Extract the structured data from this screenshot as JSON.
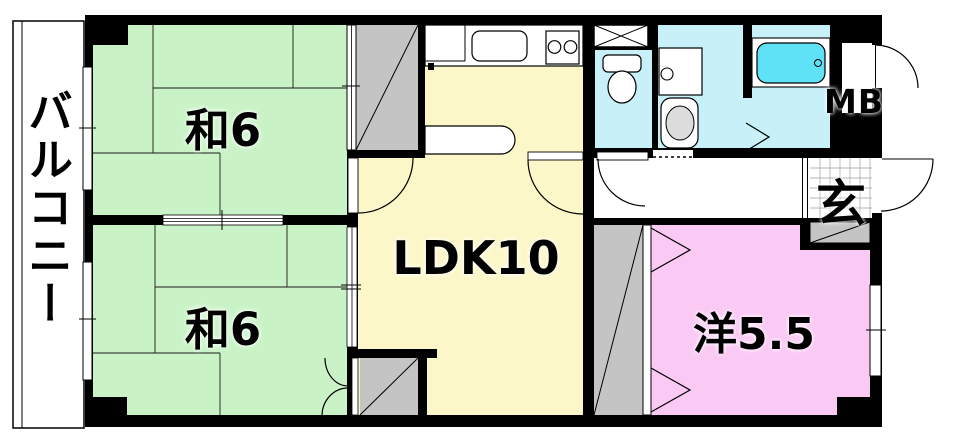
{
  "balcony": {
    "label": "バルコニー"
  },
  "rooms": {
    "japanese_top": {
      "label": "和6"
    },
    "japanese_bottom": {
      "label": "和6"
    },
    "ldk": {
      "label": "LDK10"
    },
    "western": {
      "label": "洋5.5"
    },
    "entrance": {
      "label": "玄"
    },
    "meter_box": {
      "label": "MB"
    }
  },
  "colors": {
    "wall": "#000000",
    "tatami-green": "#c9f3c6",
    "ldk-yellow": "#fcf7c9",
    "western-pink": "#fac9f4",
    "wet-blue": "#c7f0f9",
    "tub-cyan": "#5fe2f5",
    "closet-gray": "#c4c4c4",
    "machine-gray": "#dcdcdc",
    "grid-gray": "#b4b4b4"
  }
}
